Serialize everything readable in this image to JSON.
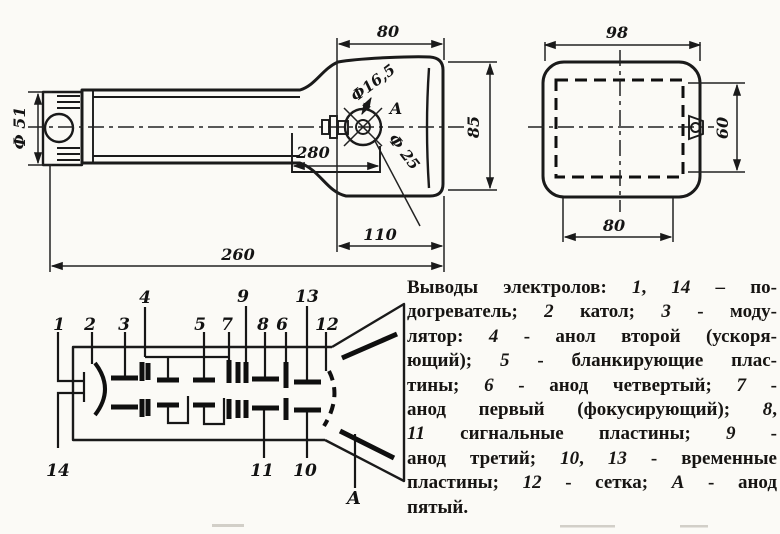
{
  "drawing": {
    "side_view": {
      "dims": {
        "diameter": "Ф 51",
        "bulb_width": "80",
        "bulb_height": "85",
        "contact_hole": "Ф16,5",
        "contact_cap": "Ф 25",
        "coating": "280",
        "bulb_length": "110",
        "total_length": "260",
        "anode_view_label": "А"
      }
    },
    "front_view": {
      "dims": {
        "width": "98",
        "height": "60",
        "screen_width": "80"
      }
    },
    "schematic": {
      "pins": {
        "p1": "1",
        "p2": "2",
        "p3": "3",
        "p4": "4",
        "p5": "5",
        "p6": "6",
        "p7": "7",
        "p8": "8",
        "p9": "9",
        "p10": "10",
        "p11": "11",
        "p12": "12",
        "p13": "13",
        "p14": "14",
        "pA": "А"
      }
    }
  },
  "caption": {
    "lines": [
      "Выводы электролов: 1, 14 – по-",
      "догреватель; 2 катол; 3 - моду-",
      "лятор: 4 - анол второй (ускоря-",
      "ющий); 5 - бланкирующие плас-",
      "тины; 6 - анод четвертый; 7 -",
      "анод первый (фокусирующий); 8,",
      "11 сигнальные пластины; 9 -",
      "анод третий; 10, 13 - временные",
      "пластины; 12 - сетка; А - анод",
      "пятый."
    ]
  }
}
